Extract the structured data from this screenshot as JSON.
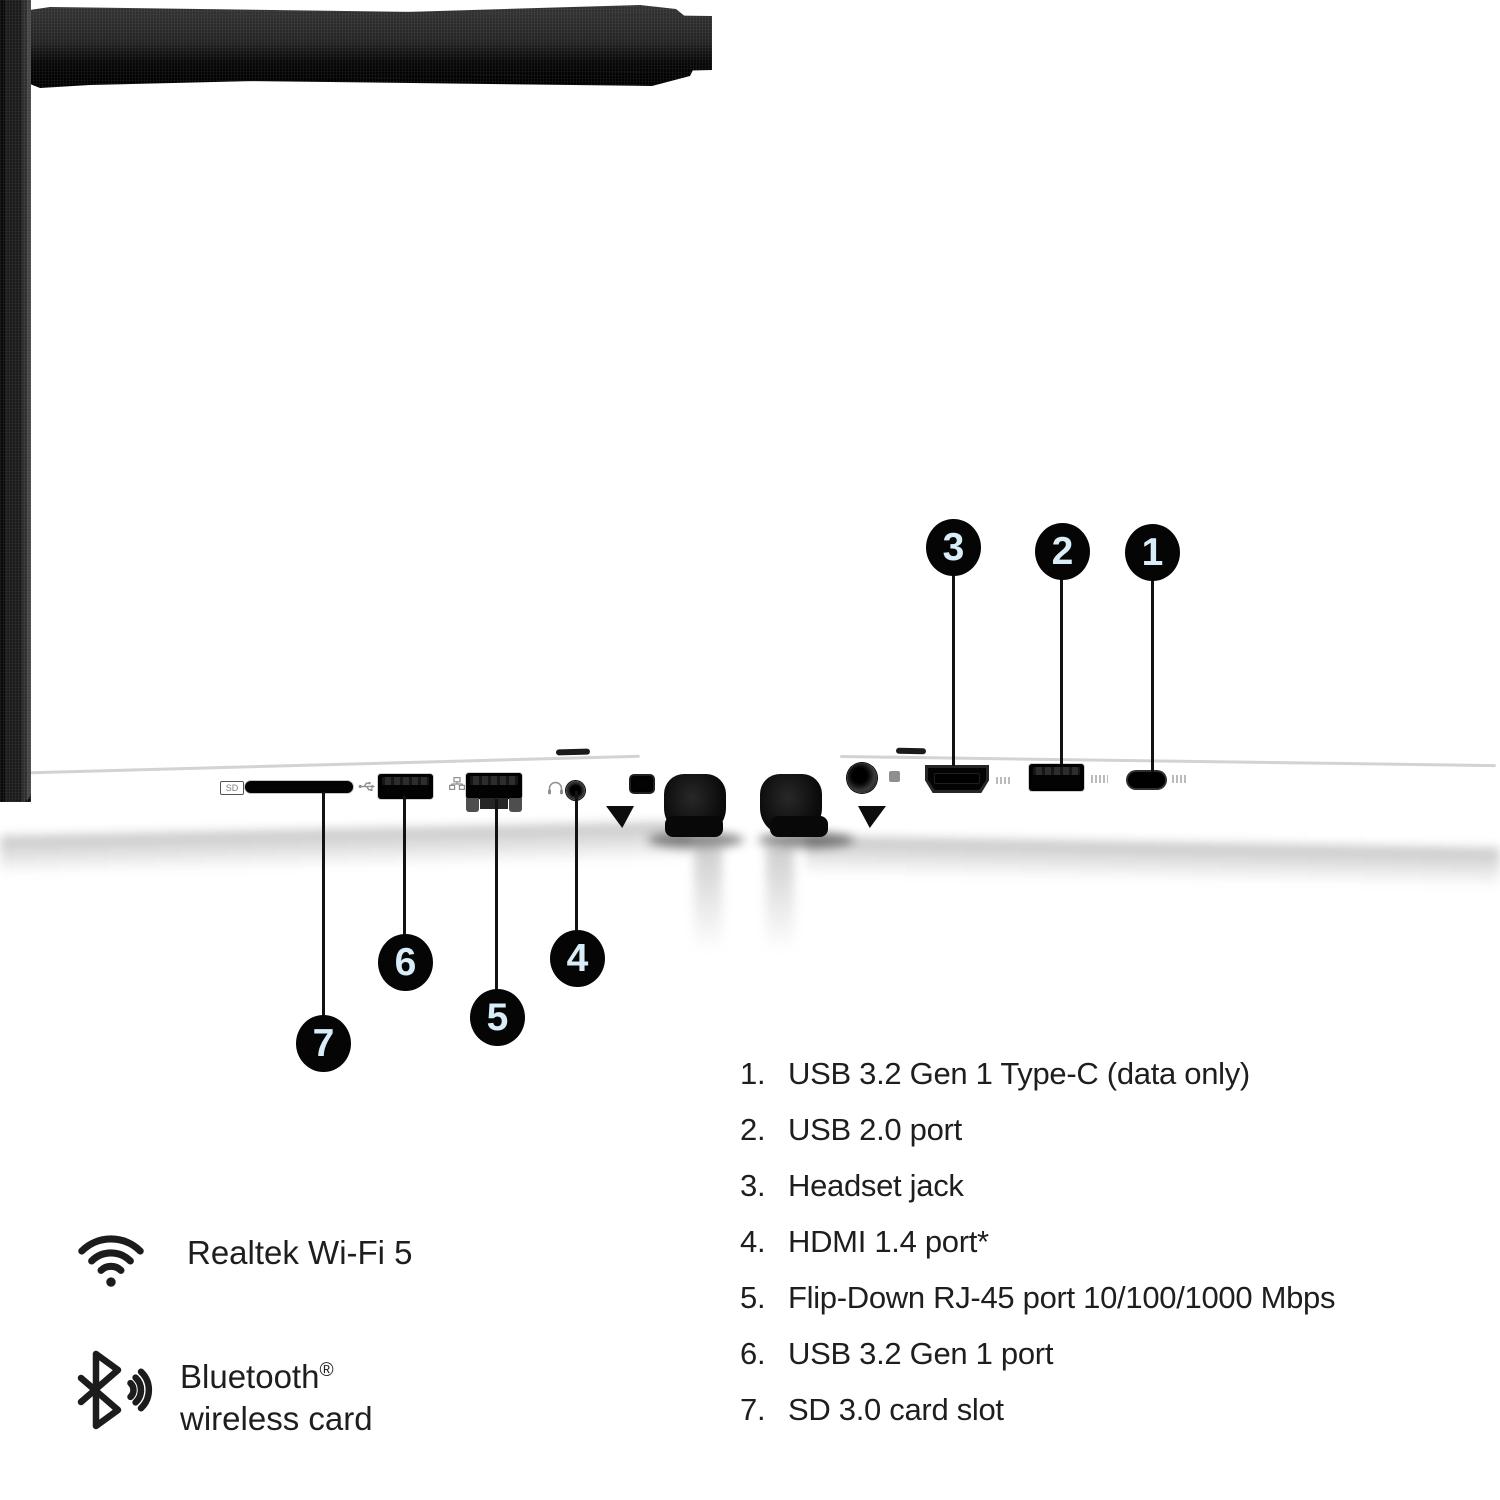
{
  "image_type": "annotated laptop side-view ports diagram",
  "callouts": [
    "1",
    "2",
    "3",
    "4",
    "5",
    "6",
    "7"
  ],
  "legend": {
    "items": [
      {
        "num": "1.",
        "label": "USB 3.2 Gen 1 Type-C (data only)"
      },
      {
        "num": "2.",
        "label": "USB 2.0 port"
      },
      {
        "num": "3.",
        "label": "Headset jack"
      },
      {
        "num": "4.",
        "label": "HDMI 1.4 port*"
      },
      {
        "num": "5.",
        "label": "Flip-Down RJ-45 port 10/100/1000 Mbps"
      },
      {
        "num": "6.",
        "label": "USB 3.2 Gen 1 port"
      },
      {
        "num": "7.",
        "label": "SD 3.0 card slot"
      }
    ]
  },
  "features": {
    "wifi": {
      "icon": "wifi-icon",
      "label": "Realtek Wi-Fi 5"
    },
    "bluetooth": {
      "icon": "bluetooth-icon",
      "line1": "Bluetooth",
      "registered_mark": "®",
      "line2": "wireless card"
    }
  },
  "port_labels": {
    "sd": "SD"
  },
  "icons": [
    "wifi-icon",
    "bluetooth-icon",
    "usb-trident-icon",
    "ethernet-icon",
    "headset-icon"
  ],
  "colors": {
    "background": "#ffffff",
    "laptop_black": "#1d1d1d",
    "callout_circle_fill": "#050505",
    "callout_number_color": "#d8edf7",
    "legend_text_color": "#1e1e1e",
    "line_color": "#121212"
  }
}
